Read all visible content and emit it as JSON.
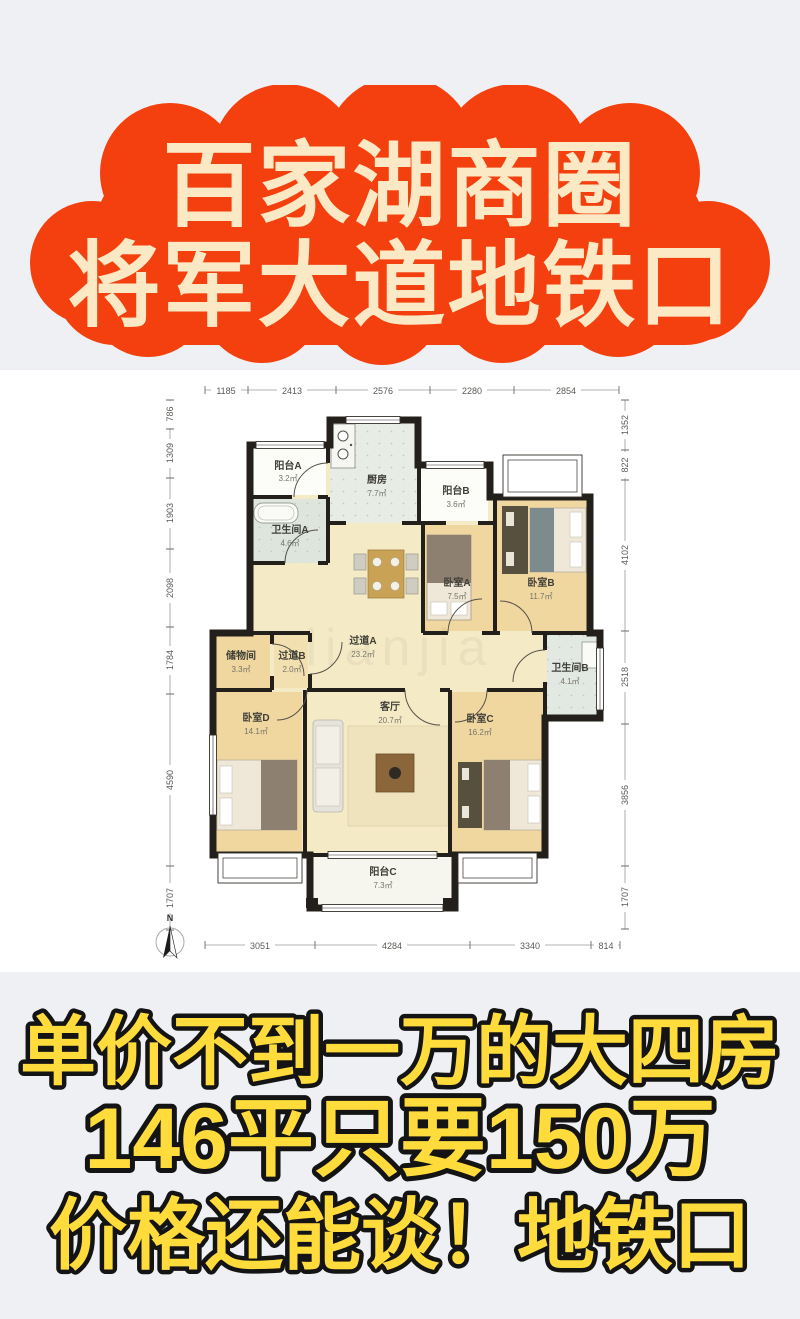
{
  "banner": {
    "line1": "百家湖商圈",
    "line2": "将军大道地铁口"
  },
  "floorplan": {
    "compass_label": "N",
    "watermark": "lianjia",
    "dims_top": [
      "1185",
      "2413",
      "2576",
      "2280",
      "2854"
    ],
    "dims_bottom": [
      "3051",
      "4284",
      "3340",
      "814"
    ],
    "dims_left": [
      "786",
      "1309",
      "1903",
      "2098",
      "1784",
      "4590",
      "1707"
    ],
    "dims_right": [
      "1352",
      "822",
      "4102",
      "2518",
      "3856",
      "1707"
    ],
    "rooms": [
      {
        "name": "阳台A",
        "area": "3.2㎡"
      },
      {
        "name": "厨房",
        "area": "7.7㎡"
      },
      {
        "name": "阳台B",
        "area": "3.6㎡"
      },
      {
        "name": "卫生间A",
        "area": "4.6㎡"
      },
      {
        "name": "卧室A",
        "area": "7.5㎡"
      },
      {
        "name": "卧室B",
        "area": "11.7㎡"
      },
      {
        "name": "储物间",
        "area": "3.3㎡"
      },
      {
        "name": "过道B",
        "area": "2.0㎡"
      },
      {
        "name": "过道A",
        "area": "23.2㎡"
      },
      {
        "name": "卫生间B",
        "area": "4.1㎡"
      },
      {
        "name": "卧室D",
        "area": "14.1㎡"
      },
      {
        "name": "客厅",
        "area": "20.7㎡"
      },
      {
        "name": "卧室C",
        "area": "16.2㎡"
      },
      {
        "name": "阳台C",
        "area": "7.3㎡"
      }
    ]
  },
  "footer": {
    "line1": "单价不到一万的大四房",
    "line2": "146平只要150万",
    "line3": "价格还能谈！地铁口"
  },
  "colors": {
    "page_bg": "#eef0f3",
    "cloud_red": "#f4400e",
    "banner_text": "#fbe9c6",
    "footer_yellow": "#ffdc3c",
    "footer_outline": "#141414",
    "wall": "#23201b",
    "bedroom_floor": "#f0d79f",
    "living_floor": "#f5eac6",
    "tile_floor": "#e7ece4",
    "balcony_floor": "#fcfcf8"
  }
}
